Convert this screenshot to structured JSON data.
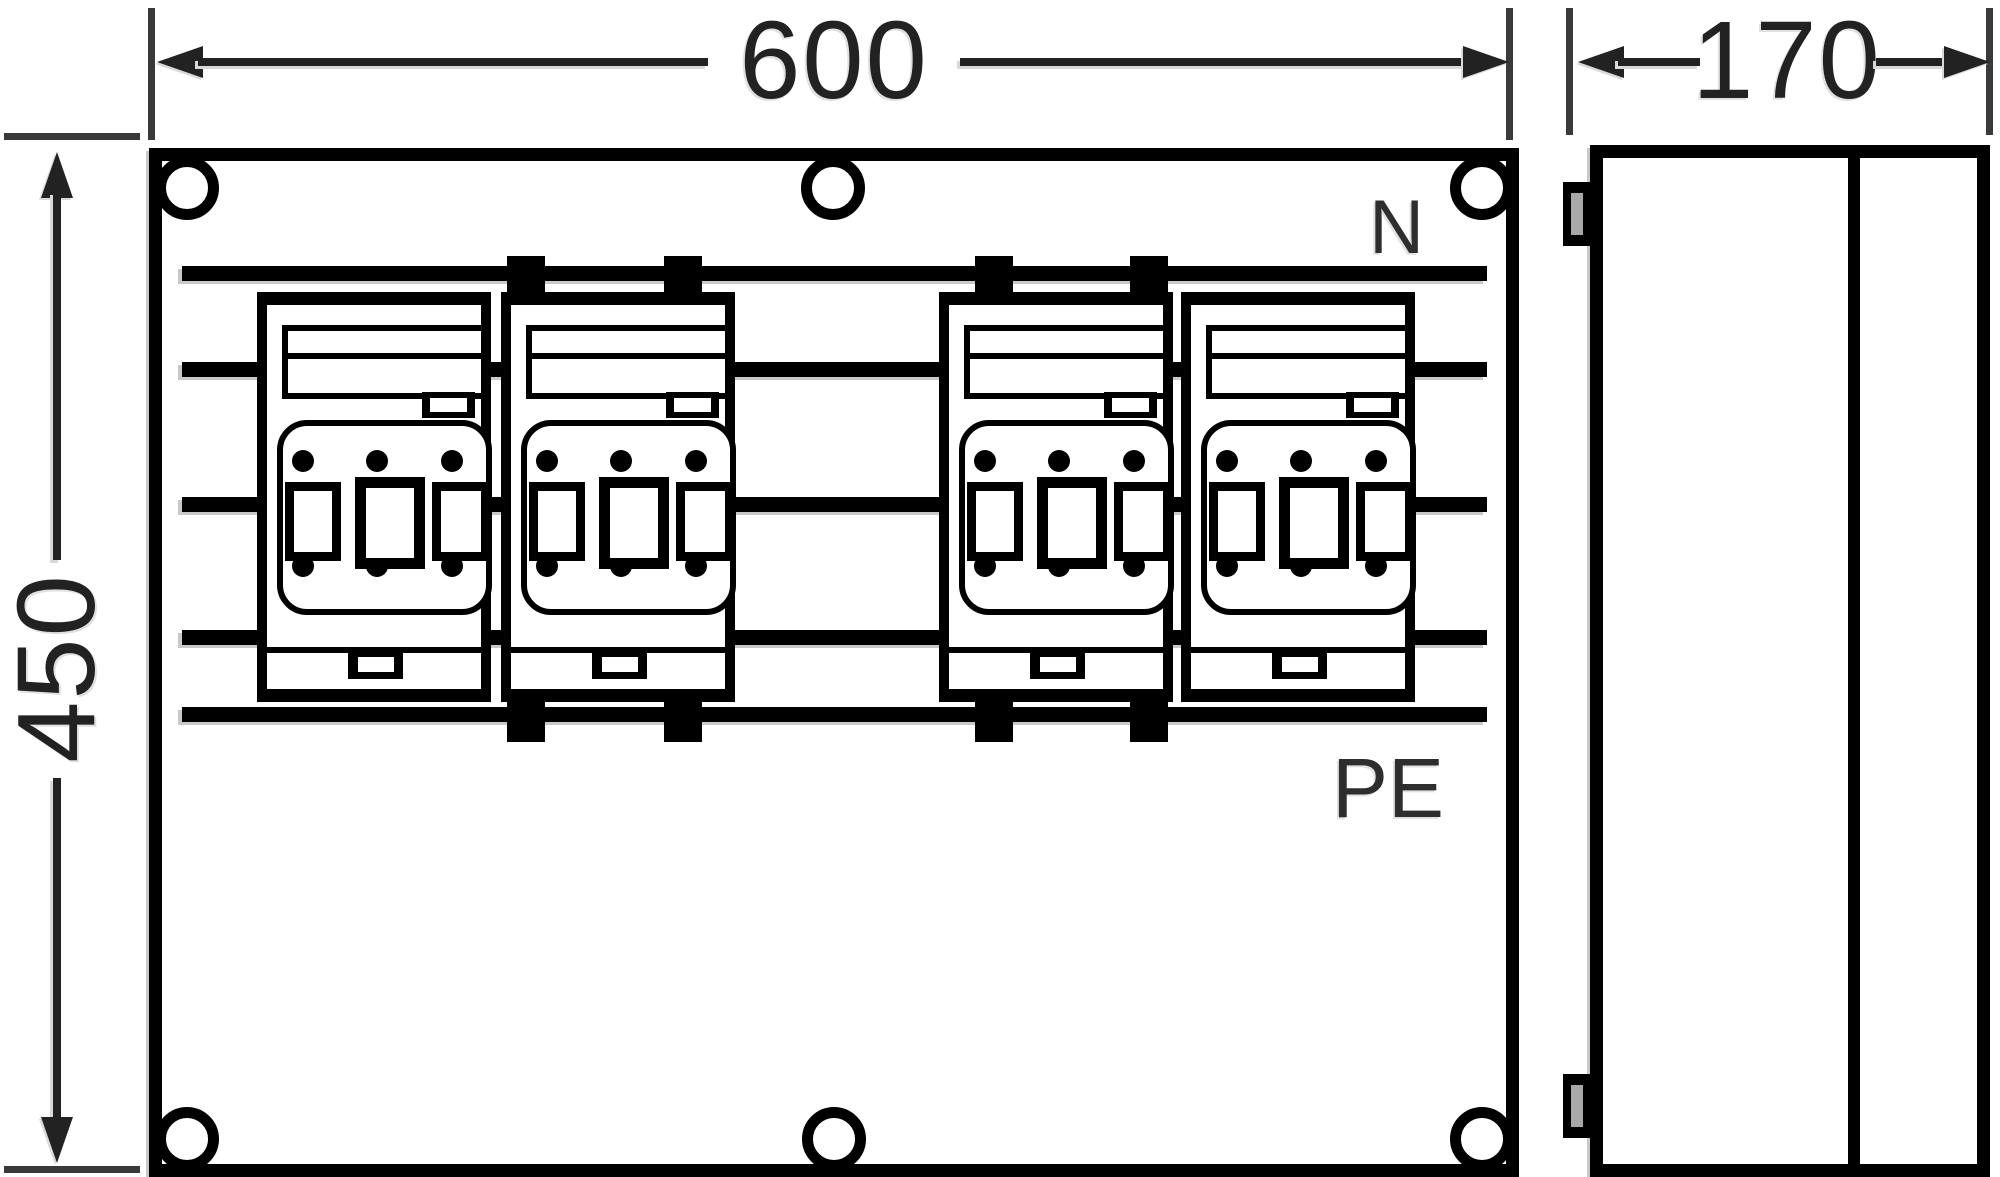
{
  "colors": {
    "ink": "#000000",
    "paper": "#ffffff",
    "shadow": "#c9c9c9",
    "annotation": "#222222",
    "clipslot": "#a8a8a8"
  },
  "annotations": {
    "width_dim": {
      "label": "600"
    },
    "depth_dim": {
      "label": "170"
    },
    "height_dim": {
      "label": "450"
    }
  },
  "front_view": {
    "busbar_labels": {
      "neutral": "N",
      "protective_earth": "PE"
    },
    "busbar_count": 5,
    "fuse_unit_count": 4,
    "mounting_hole_count": 6,
    "clamp_tab_count": 8
  },
  "side_view": {
    "wall_clip_count": 2,
    "cover_joint_lines": 1
  }
}
